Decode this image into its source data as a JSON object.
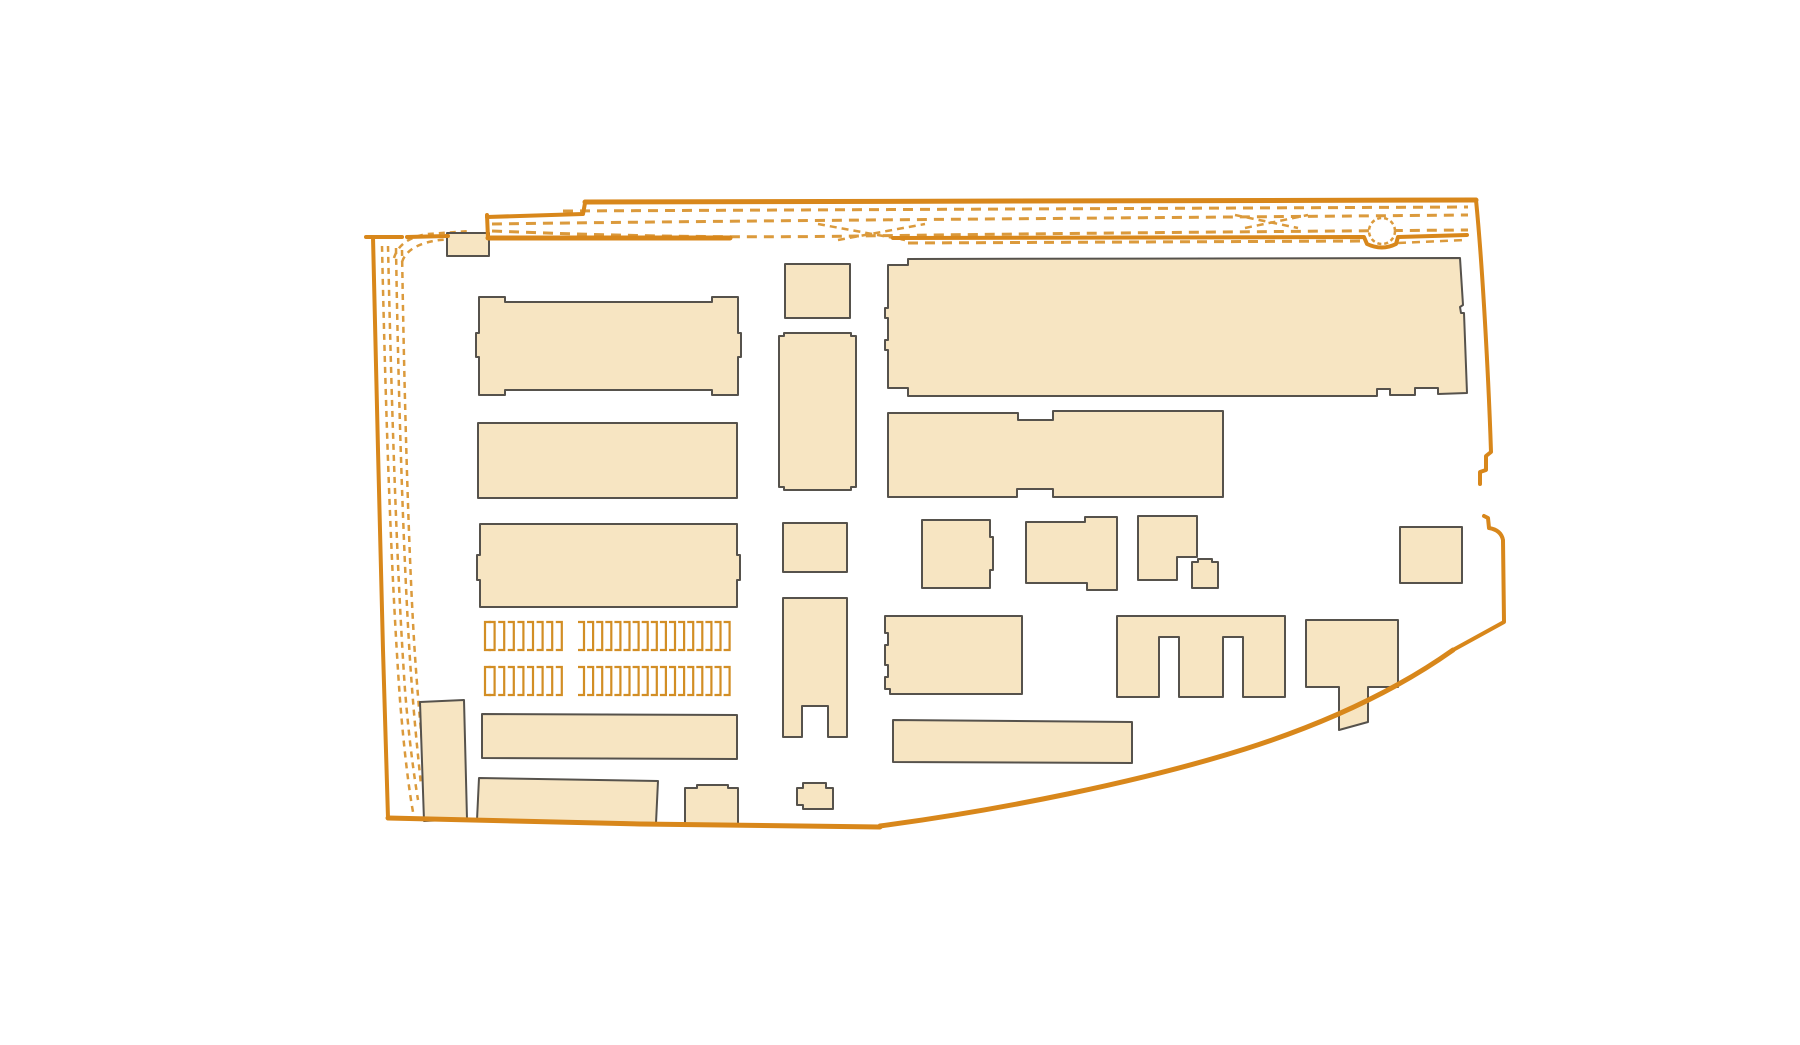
{
  "page": {
    "background": "#ffffff",
    "kind": "architectural-site-plan"
  },
  "colors": {
    "building_fill": "#F7E5C2",
    "building_stroke": "#56524C",
    "boundary_orange": "#D8871B",
    "track_orange": "#DB9A3C",
    "stall_orange": "#D28E25",
    "circle_orange": "#DB9A3C"
  },
  "site_plan": {
    "canvas": {
      "width": 1800,
      "height": 1045
    },
    "tracks_dashed": [
      {
        "id": "top-track-1",
        "d": "M563,211 L1468,207",
        "dash": "10 7",
        "w": 3
      },
      {
        "id": "top-track-2",
        "d": "M492,224 C700,221 1000,219 1468,215",
        "dash": "10 7",
        "w": 3
      },
      {
        "id": "top-track-3",
        "d": "M492,231 C620,236 720,238 860,236 C1000,234 1200,232 1468,230",
        "dash": "10 7",
        "w": 3
      },
      {
        "id": "top-track-4",
        "d": "M908,243 L1366,241",
        "dash": "10 7",
        "w": 3
      },
      {
        "id": "top-track-5",
        "d": "M1398,243 L1466,240",
        "dash": "8 6",
        "w": 2.5
      },
      {
        "id": "crossover-1",
        "d": "M818,224 L905,240",
        "dash": "7 5",
        "w": 2.5
      },
      {
        "id": "crossover-2",
        "d": "M838,240 L925,224",
        "dash": "7 5",
        "w": 2.5
      },
      {
        "id": "crossover-3",
        "d": "M1235,215 L1298,228",
        "dash": "7 5",
        "w": 2.5
      },
      {
        "id": "crossover-4",
        "d": "M1245,228 L1308,215",
        "dash": "7 5",
        "w": 2.5
      },
      {
        "id": "junction-curve-1",
        "d": "M394,258 Q400,238 428,234 L470,231",
        "dash": "6 5",
        "w": 2.5
      },
      {
        "id": "junction-curve-2",
        "d": "M402,262 Q408,244 440,240 L488,237",
        "dash": "6 5",
        "w": 2.5
      },
      {
        "id": "left-track-1",
        "d": "M382,246 C385,380 390,560 400,700 C404,750 409,790 413,812",
        "dash": "6 5",
        "w": 2.5
      },
      {
        "id": "left-track-2",
        "d": "M388,246 C391,380 396,560 405,690 C409,740 414,775 418,800",
        "dash": "6 5",
        "w": 2.5
      },
      {
        "id": "left-track-3",
        "d": "M396,248 C398,380 403,550 410,660 C414,720 418,755 421,785",
        "dash": "6 5",
        "w": 2.5
      },
      {
        "id": "left-track-4",
        "d": "M402,250 C404,380 408,540 414,640 C417,690 421,730 424,765",
        "dash": "6 5",
        "w": 2.5
      }
    ],
    "turntable_circle": {
      "cx": 1382,
      "cy": 231,
      "r": 13,
      "dash": "4 3",
      "w": 2.5
    },
    "buildings": [
      {
        "id": "small-top-shed",
        "points": "447,233 489,233 489,256 447,256"
      },
      {
        "id": "left-hall-1",
        "points": "479,297 505,297 505,302 712,302 712,297 738,297 738,333 741,333 741,357 738,357 738,395 712,395 712,390 505,390 505,395 479,395 479,357 476,357 476,333 479,333"
      },
      {
        "id": "left-hall-2",
        "points": "478,423 737,423 737,498 478,498"
      },
      {
        "id": "left-hall-3",
        "points": "480,524 737,524 737,555 740,555 740,580 737,580 737,607 480,607 480,580 477,580 477,555 480,555"
      },
      {
        "id": "narrow-tilted-building",
        "points": "420,702 464,700 467,819 424,821"
      },
      {
        "id": "left-hall-4",
        "points": "482,714 737,715 737,759 482,758"
      },
      {
        "id": "bottom-left-hall",
        "points": "479,778 658,781 656,823 477,820"
      },
      {
        "id": "bottom-left-small",
        "points": "685,788 697,788 697,785 728,785 728,788 738,788 738,826 685,826"
      },
      {
        "id": "mid-small-1",
        "points": "785,264 850,264 850,318 785,318"
      },
      {
        "id": "mid-tall-1",
        "points": "779,336 784,336 784,333 851,333 851,336 856,336 856,487 851,487 851,490 784,490 784,487 779,487"
      },
      {
        "id": "mid-small-2",
        "points": "783,523 847,523 847,572 783,572"
      },
      {
        "id": "mid-tall-2-notched",
        "points": "783,598 847,598 847,737 828,737 828,706 802,706 802,737 783,737"
      },
      {
        "id": "mid-tiny-blob",
        "points": "797,788 803,788 803,783 826,783 826,788 833,788 833,809 803,809 803,805 797,805"
      },
      {
        "id": "big-north-hall",
        "points": "888,265 908,265 908,259 1460,258 1463,305 1460,307 1461,313 1464,313 1467,393 1438,394 1438,388 1415,388 1415,395 1390,395 1390,389 1377,389 1377,396 908,396 908,388 888,388 888,350 885,350 885,340 888,340 888,318 885,318 885,308 888,308"
      },
      {
        "id": "wide-hall-2",
        "points": "888,413 1018,413 1018,420 1053,420 1053,411 1223,411 1223,497 1053,497 1053,489 1017,489 1017,497 888,497"
      },
      {
        "id": "mid-square-bump",
        "points": "922,520 990,520 990,537 993,537 993,570 990,570 990,588 922,588"
      },
      {
        "id": "stepped-building",
        "points": "1026,522 1085,522 1085,517 1117,517 1117,590 1087,590 1087,583 1026,583"
      },
      {
        "id": "l-shaped-building",
        "points": "1138,516 1197,516 1197,557 1177,557 1177,580 1138,580"
      },
      {
        "id": "tiny-square",
        "points": "1192,562 1198,562 1198,559 1212,559 1212,562 1218,562 1218,588 1192,588"
      },
      {
        "id": "far-right-square",
        "points": "1400,527 1462,527 1462,583 1400,583"
      },
      {
        "id": "mid-hall-notched-left",
        "points": "885,616 1022,616 1022,694 890,694 890,689 885,689 885,677 888,677 888,665 885,665 885,645 888,645 888,633 885,633"
      },
      {
        "id": "e-shaped-building",
        "points": "1117,616 1285,616 1285,697 1243,697 1243,637 1223,637 1223,697 1179,697 1179,637 1159,637 1159,697 1117,697"
      },
      {
        "id": "t-shaped-building",
        "points": "1306,620 1398,620 1398,687 1368,687 1368,722 1339,730 1339,687 1306,687"
      },
      {
        "id": "bottom-mid-hall",
        "points": "893,720 1132,722 1132,763 893,762"
      }
    ],
    "boundary_solid": [
      {
        "id": "top-boundary",
        "d": "M585,202 L1476,200",
        "w": 5
      },
      {
        "id": "merge-line",
        "d": "M487,217 L583,214 L585,203",
        "w": 4
      },
      {
        "id": "connector-vertical",
        "d": "M487,215 L488,238",
        "w": 4
      },
      {
        "id": "inner-road-line",
        "d": "M488,238 L730,238",
        "w": 5
      },
      {
        "id": "right-road-line",
        "d": "M893,238 L1364,237 L1367,244 Q1382,251 1396,244 L1398,237 L1467,235",
        "w": 4
      },
      {
        "id": "topleft-stub-1",
        "d": "M366,237 L402,237",
        "w": 4
      },
      {
        "id": "topleft-stub-2",
        "d": "M407,237 L448,236",
        "w": 4
      },
      {
        "id": "left-boundary",
        "d": "M373,237 L378,450 L383,650 L388,818",
        "w": 4
      },
      {
        "id": "bottom-left-boundary",
        "d": "M388,818 L640,824 L880,827",
        "w": 5
      },
      {
        "id": "bottom-curve-boundary",
        "d": "M880,826 C1000,810 1140,782 1245,749 C1330,722 1398,689 1453,650",
        "w": 5
      },
      {
        "id": "right-lower-boundary",
        "d": "M1453,650 L1504,622 L1503,540 Q1501,530 1489,528 L1488,518 L1484,516",
        "w": 4
      },
      {
        "id": "right-upper-boundary",
        "d": "M1476,200 C1483,270 1489,390 1491,452 L1486,456 L1486,470 L1480,472 L1480,484",
        "w": 4
      }
    ],
    "stall_rows": [
      {
        "id": "stall-row-1",
        "y": 622,
        "height": 28,
        "tick": 6,
        "groups": [
          {
            "x": 485,
            "count": 9,
            "pitch": 9.6,
            "lead_open": true
          },
          {
            "x": 584,
            "count": 17,
            "pitch": 9.1,
            "lead_open": false
          }
        ]
      },
      {
        "id": "stall-row-2",
        "y": 667,
        "height": 28,
        "tick": 6,
        "groups": [
          {
            "x": 485,
            "count": 9,
            "pitch": 9.6,
            "lead_open": true
          },
          {
            "x": 584,
            "count": 17,
            "pitch": 9.1,
            "lead_open": false
          }
        ]
      }
    ]
  }
}
